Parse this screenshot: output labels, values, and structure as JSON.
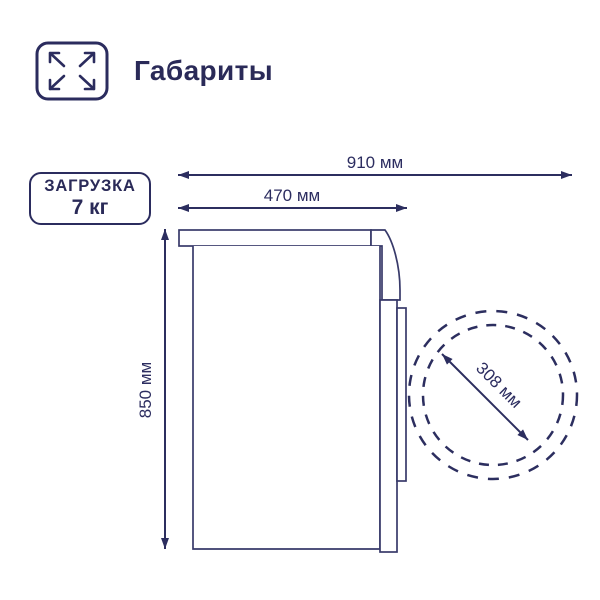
{
  "header": {
    "title": "Габариты"
  },
  "load_badge": {
    "label": "ЗАГРУЗКА",
    "value": "7 кг"
  },
  "diagram": {
    "machine": "стиральная машина (вид сбоку)",
    "dimension_depth_with_door": "910 мм",
    "dimension_depth_body": "470 мм",
    "dimension_height": "850 мм",
    "dimension_door_diameter": "308 мм"
  },
  "colors": {
    "accent_navy": "#2b2c5e",
    "background": "#ffffff"
  }
}
